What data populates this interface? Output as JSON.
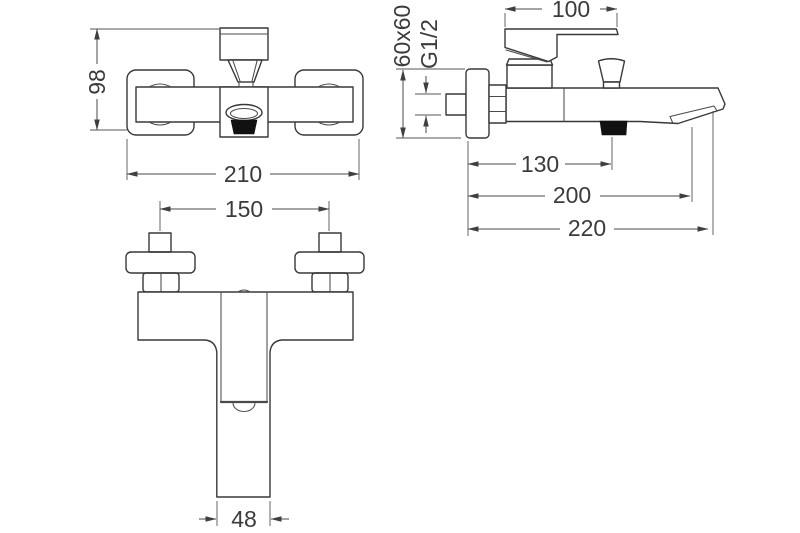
{
  "drawing": {
    "background": "#ffffff",
    "ink": "#383838",
    "accent_fill": "#111111",
    "views": {
      "front": {
        "overall_height": "98",
        "overall_width": "210"
      },
      "top": {
        "inlet_centers": "150",
        "spout_width": "48"
      },
      "side": {
        "handle_length": "100",
        "escutcheon_size": "60x60",
        "thread_size": "G1/2",
        "wall_to_shower_outlet": "130",
        "wall_to_spout_outlet": "200",
        "overall_depth": "220"
      }
    }
  }
}
